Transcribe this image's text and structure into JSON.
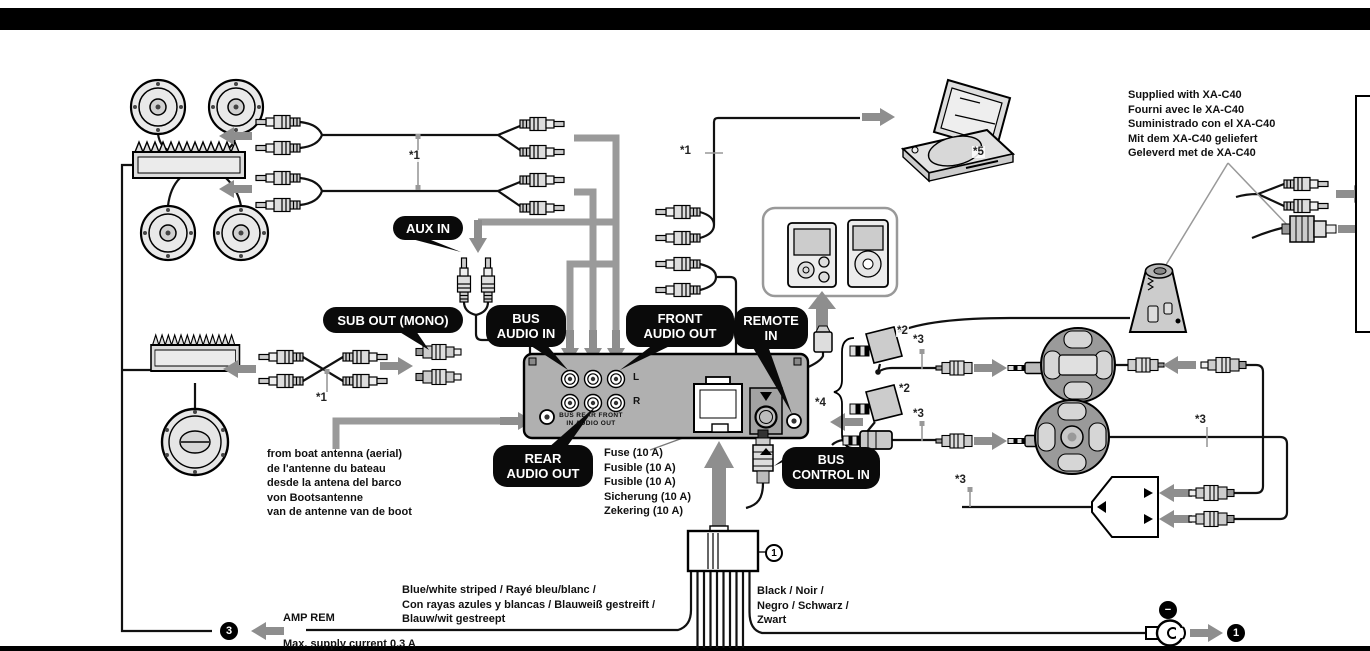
{
  "bubbles": {
    "aux_in": "AUX IN",
    "sub_out": "SUB OUT (MONO)",
    "bus_audio_in": [
      "BUS",
      "AUDIO IN"
    ],
    "front_audio_out": [
      "FRONT",
      "AUDIO OUT"
    ],
    "remote_in": [
      "REMOTE",
      "IN"
    ],
    "rear_audio_out": [
      "REAR",
      "AUDIO OUT"
    ],
    "bus_control_in": [
      "BUS",
      "CONTROL IN"
    ]
  },
  "notes": {
    "supplied": [
      "Supplied with XA-C40",
      "Fourni avec le XA-C40",
      "Suministrado con el XA-C40",
      "Mit dem XA-C40 geliefert",
      "Geleverd met de XA-C40"
    ],
    "antenna": [
      "from boat antenna (aerial)",
      "de l'antenne du bateau",
      "desde la antena del barco",
      "von Bootsantenne",
      "van de antenne van de boot"
    ],
    "fuse": [
      "Fuse (10 A)",
      "Fusible (10 A)",
      "Fusible (10 A)",
      "Sicherung (10 A)",
      "Zekering (10 A)"
    ],
    "blue_white_wire": [
      "Blue/white striped / Rayé bleu/blanc /",
      "Con rayas azules y blancas / Blauweiß gestreift /",
      "Blauw/wit gestreept"
    ],
    "black_wire": [
      "Black / Noir /",
      "Negro / Schwarz /",
      "Zwart"
    ],
    "amp_rem": "AMP REM",
    "max_current": "Max. supply current 0.3 A"
  },
  "unit": {
    "channel_left": "L",
    "channel_right": "R",
    "ports_top": "BUS REAR FRONT",
    "ports_bottom": "IN AUDIO OUT"
  },
  "asterisks": {
    "a1": "*1",
    "a2": "*2",
    "a3": "*3",
    "a4": "*4",
    "a5": "*5"
  },
  "badges": {
    "amp_rem_terminal": "3",
    "harness_connector": "1",
    "ground_terminal": "1",
    "minus": "−"
  },
  "colors": {
    "accent_gray": "#8e8e8e",
    "bubble_black": "#0a0a0a",
    "unit_gray": "#b0b0b0",
    "line_black": "#111111"
  }
}
